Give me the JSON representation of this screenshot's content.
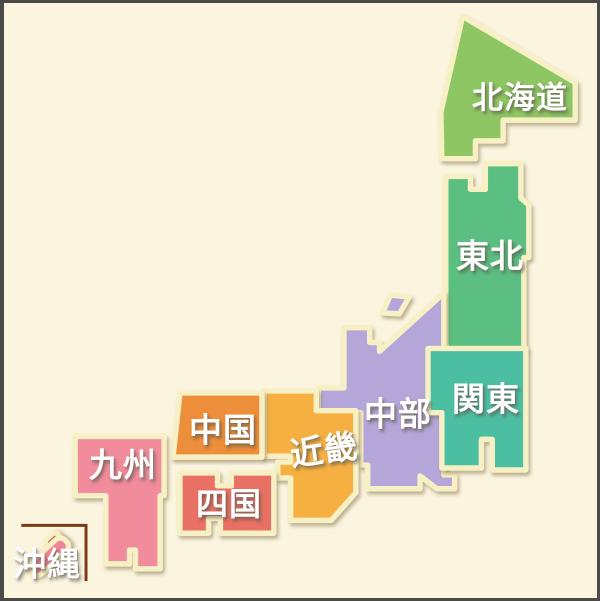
{
  "background": "#fbf5e0",
  "border_color": "#4a4a48",
  "stroke_color": "#f8f0c5",
  "text_color": "#ffffff",
  "okinawa_frame_color": "#7b3b16",
  "okinawa_small_island_color": "#c9485b",
  "regions": [
    {
      "id": "hokkaido",
      "label": "北海道",
      "color": "#8dc663"
    },
    {
      "id": "tohoku",
      "label": "東北",
      "color": "#5abf80"
    },
    {
      "id": "kanto",
      "label": "関東",
      "color": "#4cbfa2"
    },
    {
      "id": "chubu",
      "label": "中部",
      "color": "#b5a6da"
    },
    {
      "id": "kinki",
      "label": "近畿",
      "color": "#f6b042"
    },
    {
      "id": "chugoku",
      "label": "中国",
      "color": "#ec8e3a"
    },
    {
      "id": "shikoku",
      "label": "四国",
      "color": "#e97064"
    },
    {
      "id": "kyushu",
      "label": "九州",
      "color": "#f08c9b"
    },
    {
      "id": "okinawa",
      "label": "沖縄",
      "color": "#ee8494"
    }
  ]
}
